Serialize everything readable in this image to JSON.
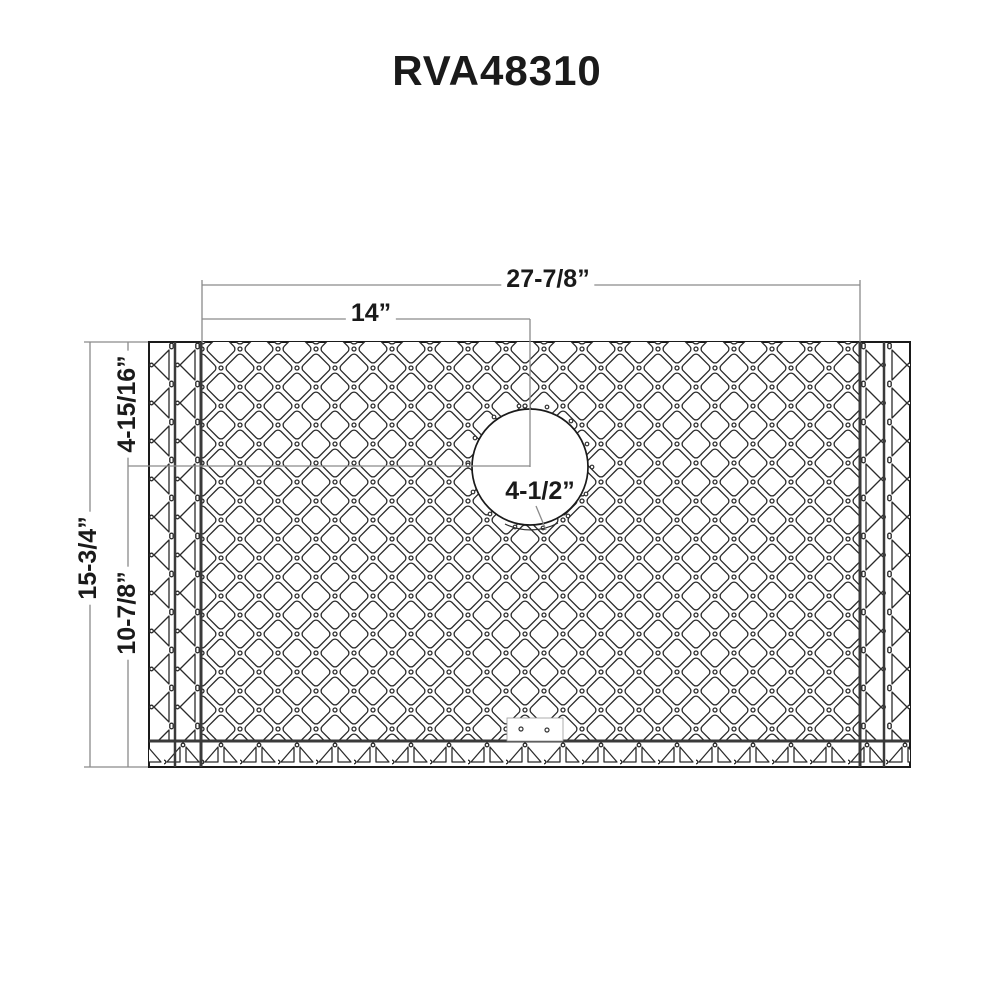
{
  "title": "RVA48310",
  "drawing": {
    "type": "dimensioned technical drawing of sink bottom grid",
    "dimensions": {
      "overall_width": "27-7/8”",
      "hole_center_from_left": "14”",
      "hole_center_from_top": "4-15/16”",
      "overall_height": "15-3/4”",
      "hole_center_from_bottom": "10-7/8”",
      "hole_diameter": "4-1/2”"
    },
    "colors": {
      "background": "#ffffff",
      "pattern_line": "#2b2b2b",
      "frame_line": "#1a1a1a",
      "dimension_line": "#8a8a8a",
      "text": "#1a1a1a"
    }
  }
}
